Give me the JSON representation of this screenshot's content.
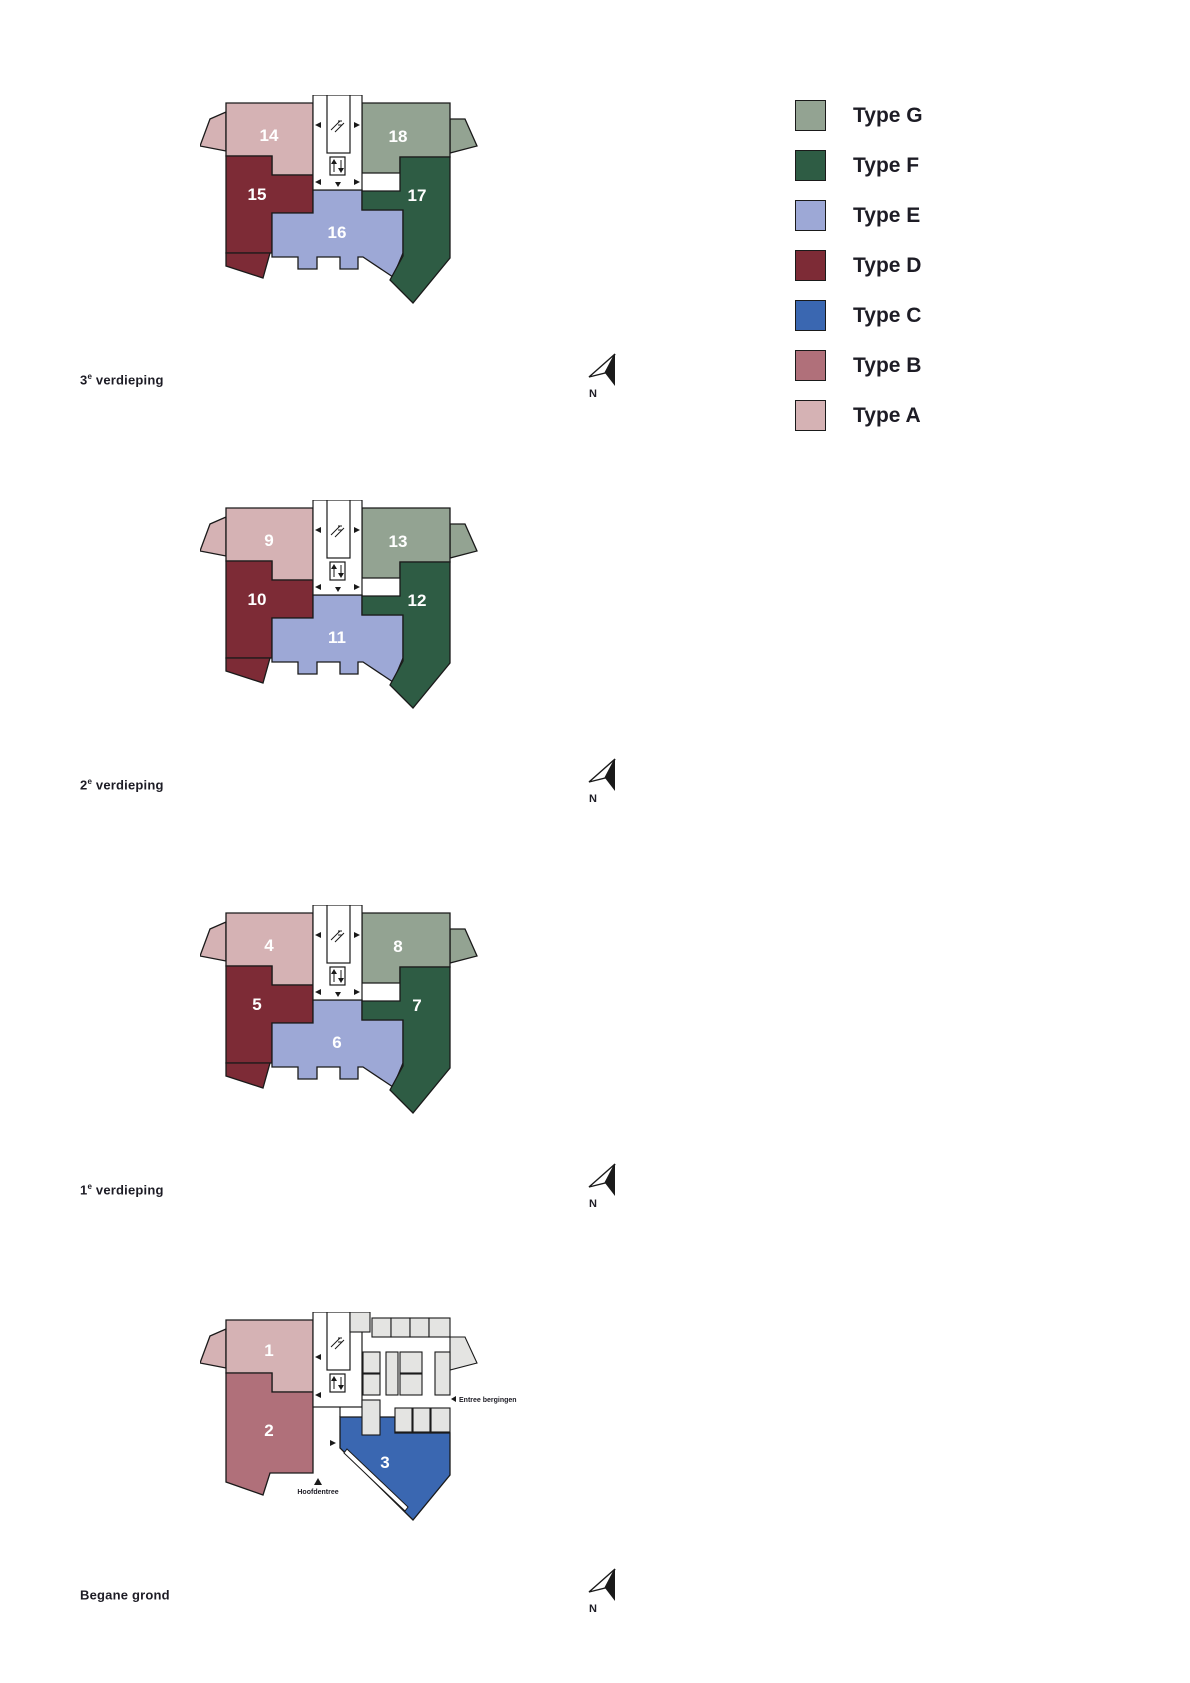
{
  "colors": {
    "type_a": "#D5B2B4",
    "type_b": "#B0707A",
    "type_c": "#3A67B1",
    "type_d": "#7D2B36",
    "type_e": "#9DA8D6",
    "type_f": "#2E5C44",
    "type_g": "#93A392",
    "outline": "#1A1A1A",
    "text": "#1D1C25",
    "storage": "#E4E4E2"
  },
  "legend": {
    "items": [
      {
        "label": "Type G",
        "color": "#93A392"
      },
      {
        "label": "Type F",
        "color": "#2E5C44"
      },
      {
        "label": "Type E",
        "color": "#9DA8D6"
      },
      {
        "label": "Type D",
        "color": "#7D2B36"
      },
      {
        "label": "Type C",
        "color": "#3A67B1"
      },
      {
        "label": "Type B",
        "color": "#B0707A"
      },
      {
        "label": "Type A",
        "color": "#D5B2B4"
      }
    ]
  },
  "floors": [
    {
      "label": {
        "prefix": "3",
        "sup": "e",
        "suffix": " verdieping"
      },
      "north": "N",
      "units": [
        {
          "number": "14",
          "type": "A"
        },
        {
          "number": "15",
          "type": "D"
        },
        {
          "number": "16",
          "type": "E"
        },
        {
          "number": "17",
          "type": "F"
        },
        {
          "number": "18",
          "type": "G"
        }
      ]
    },
    {
      "label": {
        "prefix": "2",
        "sup": "e",
        "suffix": " verdieping"
      },
      "north": "N",
      "units": [
        {
          "number": "9",
          "type": "A"
        },
        {
          "number": "10",
          "type": "D"
        },
        {
          "number": "11",
          "type": "E"
        },
        {
          "number": "12",
          "type": "F"
        },
        {
          "number": "13",
          "type": "G"
        }
      ]
    },
    {
      "label": {
        "prefix": "1",
        "sup": "e",
        "suffix": " verdieping"
      },
      "north": "N",
      "units": [
        {
          "number": "4",
          "type": "A"
        },
        {
          "number": "5",
          "type": "D"
        },
        {
          "number": "6",
          "type": "E"
        },
        {
          "number": "7",
          "type": "F"
        },
        {
          "number": "8",
          "type": "G"
        }
      ]
    },
    {
      "label": {
        "prefix": "Begane grond",
        "sup": "",
        "suffix": ""
      },
      "north": "N",
      "units": [
        {
          "number": "1",
          "type": "A"
        },
        {
          "number": "2",
          "type": "B"
        },
        {
          "number": "3",
          "type": "C"
        }
      ],
      "annotations": {
        "entree_bergingen": "Entree bergingen",
        "hoofdentree": "Hoofdentree"
      }
    }
  ]
}
